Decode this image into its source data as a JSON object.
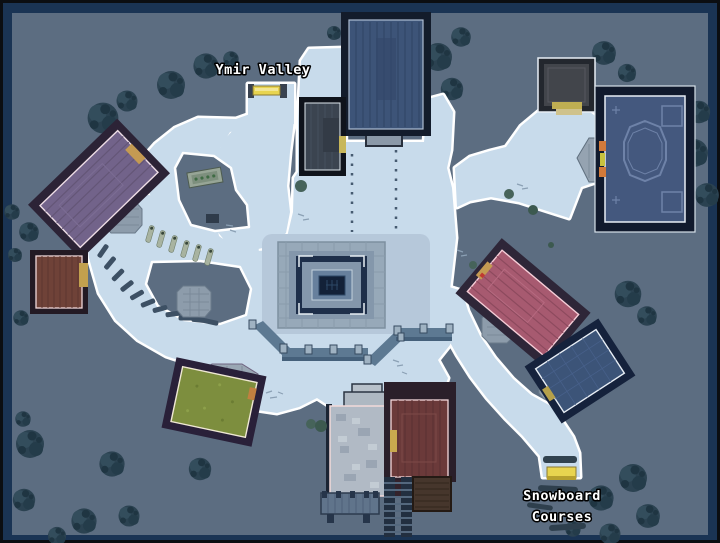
{
  "labels": {
    "region": "Ymir Valley",
    "course": {
      "lines": [
        "Snowboard",
        "Courses"
      ]
    }
  },
  "colors": {
    "frame_black": "#0b0e12",
    "frame_navy": "#1a3454",
    "ground": "#5c6d81",
    "snow": "#c8dbeb",
    "snow_outline": "#ffffff",
    "tree": "#2b4251",
    "bush": "#46635a",
    "label_text": "#ffffff",
    "label_outline": "#000000",
    "plaza_stone": "#97a9b9",
    "roof_blue": "#3d5478",
    "roof_slate": "#3b4450",
    "roof_gray": "#42454b",
    "roof_royal": "#44587e",
    "roof_purple": "#72638a",
    "roof_maroon": "#6f4238",
    "roof_green": "#7d8e3e",
    "roof_rose": "#a75a70",
    "roof_navy": "#3c5478",
    "roof_darkred": "#6b3a3a",
    "stone_building": "#b1bac5",
    "accent_yellow": "#e8d44f",
    "torch_orange": "#d27a3a"
  },
  "features": [
    {
      "id": "north-lodge",
      "roof": "roof_blue"
    },
    {
      "id": "north-annex",
      "roof": "roof_slate"
    },
    {
      "id": "northeast-cabin",
      "roof": "roof_gray"
    },
    {
      "id": "east-grand-hall",
      "roof": "roof_royal"
    },
    {
      "id": "northwest-hall",
      "roof": "roof_purple"
    },
    {
      "id": "west-cabin",
      "roof": "roof_maroon"
    },
    {
      "id": "south-green-cabin",
      "roof": "roof_green"
    },
    {
      "id": "southeast-rose-hall",
      "roof": "roof_rose"
    },
    {
      "id": "southeast-blue-cabin",
      "roof": "roof_navy"
    },
    {
      "id": "south-stone-keep",
      "roof": "stone_building"
    },
    {
      "id": "south-red-hall",
      "roof": "roof_darkred"
    },
    {
      "id": "central-plaza",
      "roof": "plaza_stone"
    }
  ]
}
